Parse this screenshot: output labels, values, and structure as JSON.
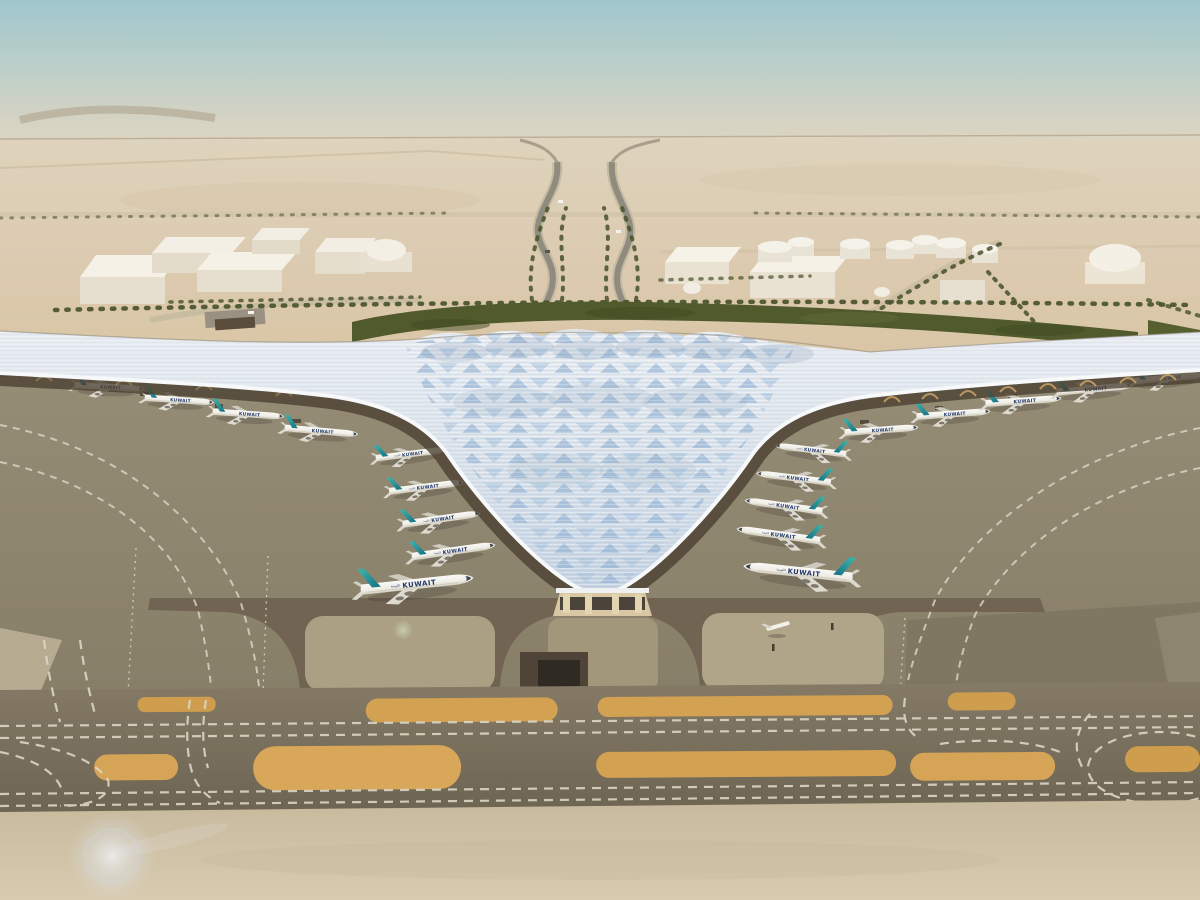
{
  "aircraft": {
    "title": "KUWAIT",
    "title_arabic": "الكويتية",
    "tail_color": "#2fa9a1",
    "fuselage_color": "#f4f2ec",
    "title_color": "#22386b"
  },
  "palette": {
    "sky_top": "#9fc6cd",
    "sky_haze": "#ded5c2",
    "desert_sand": "#dbc9a8",
    "roof_silver": "#e7ebf0",
    "solar_panel_blue": "#8fb0d2",
    "hedge_green": "#505a2c",
    "apron_gray": "#8f8672",
    "taxiway_gray": "#7a705c",
    "sand_strip_orange": "#d2a152",
    "marking_white": "#ddd7c7",
    "canopy_shadow_brown": "#4a3f31",
    "structure_gold": "#d2a968"
  }
}
